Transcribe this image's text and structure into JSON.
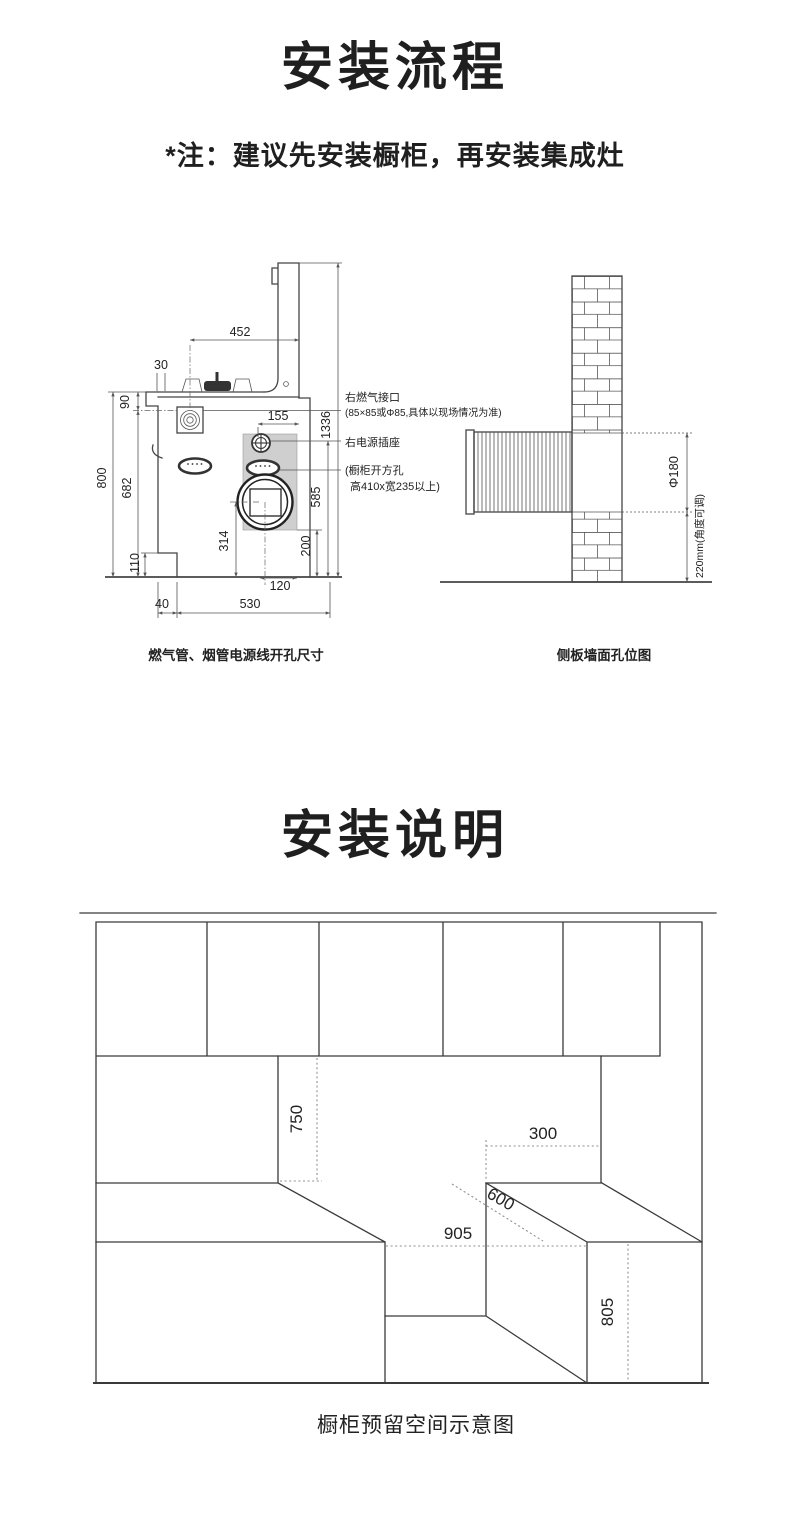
{
  "s1": {
    "title": "安装流程",
    "note": "*注：建议先安装橱柜，再安装集成灶",
    "cap_left": "燃气管、烟管电源线开孔尺寸",
    "cap_right": "侧板墙面孔位图",
    "lbl": {
      "gas": "右燃气接口",
      "gas2": "(85×85或Φ85,具体以现场情况为准)",
      "socket": "右电源插座",
      "cut1": "(橱柜开方孔",
      "cut2": "高410x宽235以上)"
    },
    "dims": {
      "452": "452",
      "30": "30",
      "90": "90",
      "800": "800",
      "682": "682",
      "110": "110",
      "40": "40",
      "530": "530",
      "120": "120",
      "314": "314",
      "200": "200",
      "585": "585",
      "1336": "1336",
      "155": "155",
      "phi180": "Φ180",
      "a220": "220mm(角度可调)"
    }
  },
  "s2": {
    "title": "安装说明",
    "caption": "橱柜预留空间示意图",
    "dims": {
      "750": "750",
      "300": "300",
      "600": "600",
      "905": "905",
      "805": "805"
    }
  },
  "colors": {
    "line": "#454545",
    "fill_gray": "#cfcfcf",
    "text": "#1f1f1f"
  }
}
